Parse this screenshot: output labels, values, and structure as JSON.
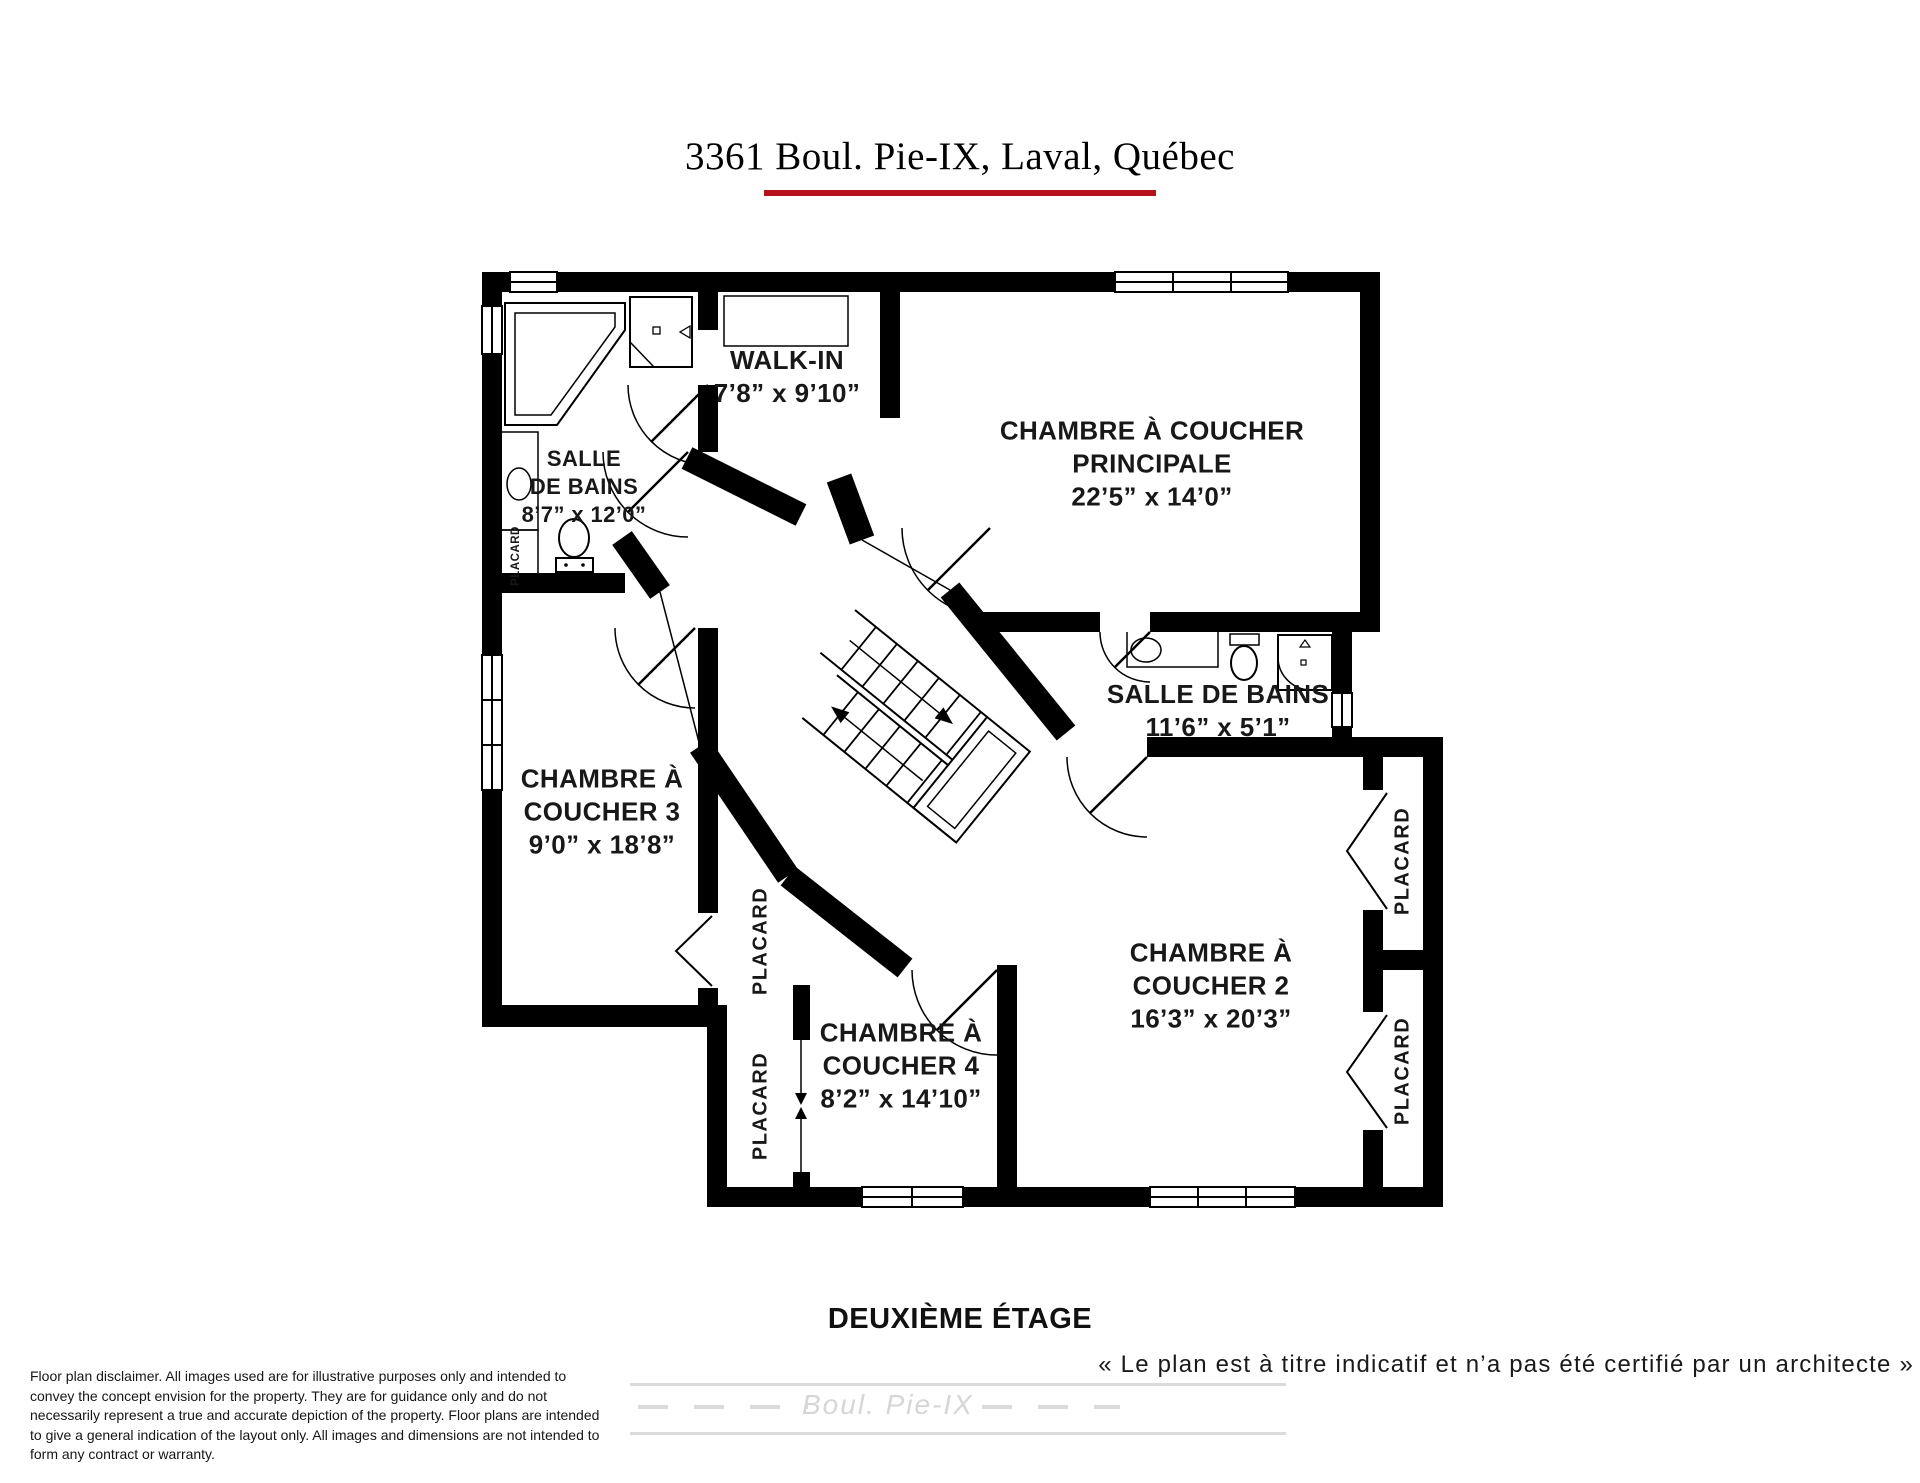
{
  "title": "3361 Boul. Pie-IX, Laval, Québec",
  "floor_label": "DEUXIÈME ÉTAGE",
  "quote": "« Le plan est à titre indicatif et n’a pas été certifié par un architecte »",
  "street_label": "Boul. Pie-IX",
  "disclaimer": "Floor plan disclaimer. All images used are for illustrative purposes only and intended to convey the concept envision for the property. They are for guidance only and do not necessarily represent a true and accurate depiction of the property. Floor plans are intended to give a general indication of the layout only. All images and dimensions are not intended to form any contract or warranty.",
  "labels": {
    "closet": "PLACARD"
  },
  "rooms": {
    "walkin": {
      "name": "WALK-IN",
      "dims": "7’8” x 9’10”"
    },
    "master": {
      "name_line1": "CHAMBRE À COUCHER",
      "name_line2": "PRINCIPALE",
      "dims": "22’5” x 14’0”"
    },
    "ensuite_bath": {
      "name_line1": "SALLE",
      "name_line2": "DE BAINS",
      "dims": "8’7” x 12’0”"
    },
    "main_bath": {
      "name": "SALLE DE BAINS",
      "dims": "11’6” x 5’1”"
    },
    "bedroom3": {
      "name_line1": "CHAMBRE À",
      "name_line2": "COUCHER 3",
      "dims": "9’0” x 18’8”"
    },
    "bedroom4": {
      "name_line1": "CHAMBRE À",
      "name_line2": "COUCHER 4",
      "dims": "8’2” x 14’10”"
    },
    "bedroom2": {
      "name_line1": "CHAMBRE À",
      "name_line2": "COUCHER 2",
      "dims": "16’3” x 20’3”"
    }
  },
  "colors": {
    "accent_red": "#b5121b",
    "wall_black": "#000000",
    "road_gray": "#dbdbdb",
    "watermark_gray": "#d6d6d6"
  }
}
